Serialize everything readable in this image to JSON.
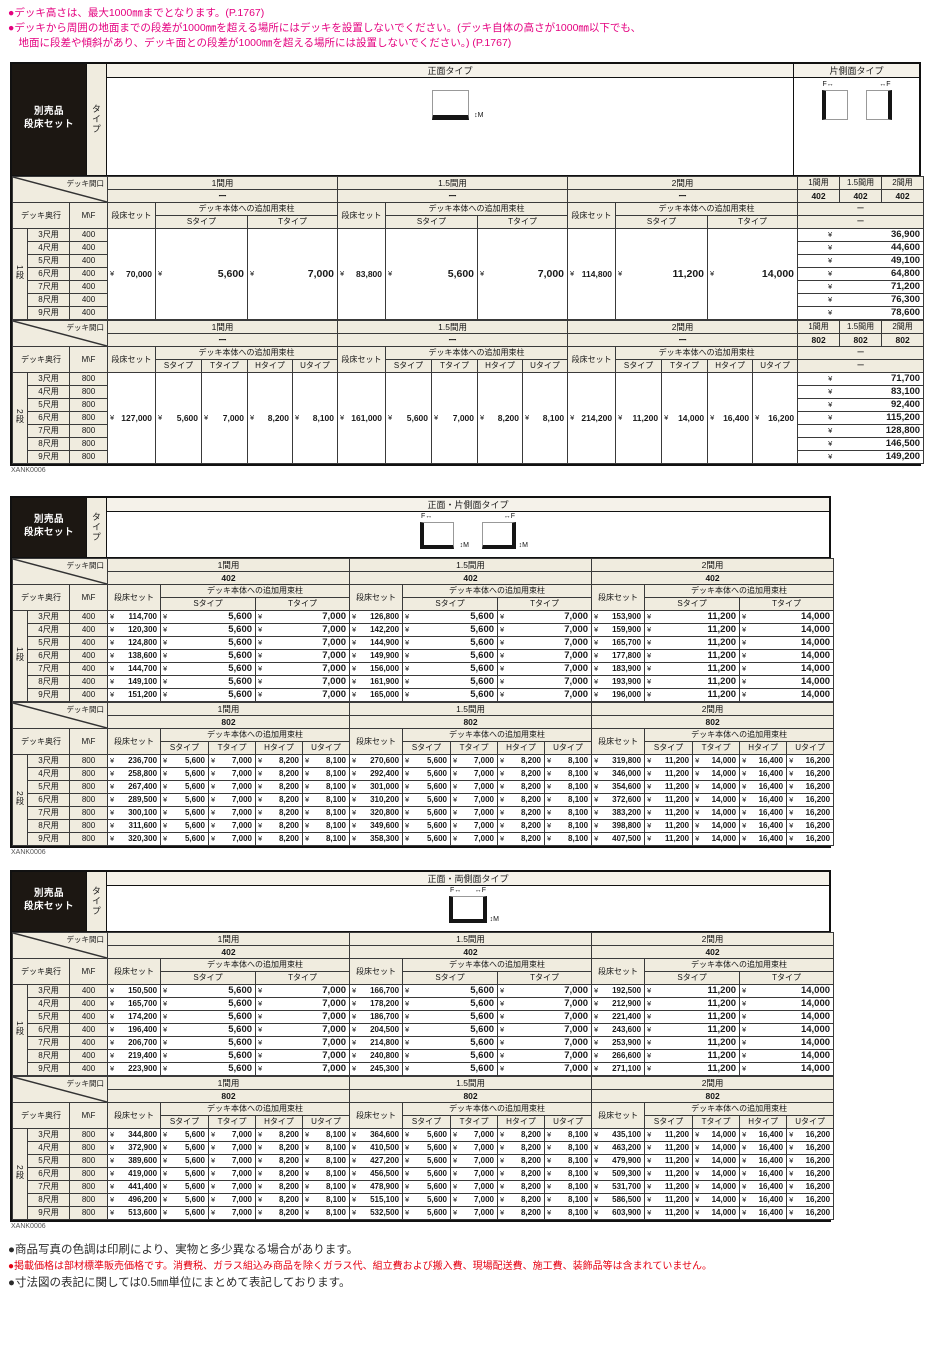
{
  "currency": "¥",
  "top_notes": [
    "●デッキ高さは、最大1000㎜までとなります。(P.1767)",
    "●デッキから周囲の地面までの段差が1000㎜を超える場所にはデッキを設置しないでください。(デッキ自体の高さが1000㎜以下でも、\n　地面に段差や傾斜があり、デッキ面との段差が1000㎜を超える場所には設置しないでください。) (P.1767)"
  ],
  "footer_notes": [
    {
      "text": "●商品写真の色調は印刷により、実物と多少異なる場合があります。",
      "color": "#2b2b2b"
    },
    {
      "text": "●掲載価格は部材標準販売価格です。消費税、ガラス組込み商品を除くガラス代、組立費および搬入費、現場配送費、施工費、装飾品等は含まれていません。",
      "color": "#e60012"
    },
    {
      "text": "●寸法図の表記に関しては0.5㎜単位にまとめて表記しております。",
      "color": "#2b2b2b"
    }
  ],
  "colors": {
    "accent_pink": "#e4007f",
    "note_red": "#e60012",
    "header_beige": "#f0ecdf",
    "badge_black": "#1c1712",
    "border_dark": "#111111"
  },
  "labels": {
    "badge": [
      "別売品",
      "段床セット"
    ],
    "type_vertical": "タイプ",
    "span_label": "デッキ間口",
    "depth_label": "デッキ奥行",
    "mf_label": "M\\F",
    "set_label": "段床セット",
    "add_label": "デッキ本体への追加用束柱",
    "dash": "ー",
    "marks": {
      "f": "F",
      "m": "M",
      "arrow_h": "↔",
      "arrow_v": "↕"
    }
  },
  "tables": [
    {
      "code": "XANK0006",
      "main_title": "正面タイプ",
      "side_title": "片側面タイプ",
      "diagram": "front",
      "has_side_block": true,
      "sections": [
        {
          "stage": "1段",
          "mf_value": "400",
          "groups": [
            "1間用",
            "1.5間用",
            "2間用"
          ],
          "group_sizes": [
            "ー",
            "ー",
            "ー"
          ],
          "side_groups": [
            "1間用",
            "1.5間用",
            "2間用"
          ],
          "side_sizes": [
            "402",
            "402",
            "402"
          ],
          "type_cols": [
            "Sタイプ",
            "Tタイプ"
          ],
          "merged_prices": [
            {
              "set": "70,000",
              "types": [
                "5,600",
                "7,000"
              ]
            },
            {
              "set": "83,800",
              "types": [
                "5,600",
                "7,000"
              ]
            },
            {
              "set": "114,800",
              "types": [
                "11,200",
                "14,000"
              ]
            }
          ],
          "rows": [
            {
              "depth": "3尺用",
              "side_price": "36,900"
            },
            {
              "depth": "4尺用",
              "side_price": "44,600"
            },
            {
              "depth": "5尺用",
              "side_price": "49,100"
            },
            {
              "depth": "6尺用",
              "side_price": "64,800"
            },
            {
              "depth": "7尺用",
              "side_price": "71,200"
            },
            {
              "depth": "8尺用",
              "side_price": "76,300"
            },
            {
              "depth": "9尺用",
              "side_price": "78,600"
            }
          ]
        },
        {
          "stage": "2段",
          "mf_value": "800",
          "groups": [
            "1間用",
            "1.5間用",
            "2間用"
          ],
          "group_sizes": [
            "ー",
            "ー",
            "ー"
          ],
          "side_groups": [
            "1間用",
            "1.5間用",
            "2間用"
          ],
          "side_sizes": [
            "802",
            "802",
            "802"
          ],
          "type_cols": [
            "Sタイプ",
            "Tタイプ",
            "Hタイプ",
            "Uタイプ"
          ],
          "merged_prices": [
            {
              "set": "127,000",
              "types": [
                "5,600",
                "7,000",
                "8,200",
                "8,100"
              ]
            },
            {
              "set": "161,000",
              "types": [
                "5,600",
                "7,000",
                "8,200",
                "8,100"
              ]
            },
            {
              "set": "214,200",
              "types": [
                "11,200",
                "14,000",
                "16,400",
                "16,200"
              ]
            }
          ],
          "rows": [
            {
              "depth": "3尺用",
              "side_price": "71,700"
            },
            {
              "depth": "4尺用",
              "side_price": "83,100"
            },
            {
              "depth": "5尺用",
              "side_price": "92,400"
            },
            {
              "depth": "6尺用",
              "side_price": "115,200"
            },
            {
              "depth": "7尺用",
              "side_price": "128,800"
            },
            {
              "depth": "8尺用",
              "side_price": "146,500"
            },
            {
              "depth": "9尺用",
              "side_price": "149,200"
            }
          ]
        }
      ]
    },
    {
      "code": "XANK0006",
      "main_title": "正面・片側面タイプ",
      "diagram": "front-side",
      "has_side_block": false,
      "sections": [
        {
          "stage": "1段",
          "mf_value": "400",
          "groups": [
            "1間用",
            "1.5間用",
            "2間用"
          ],
          "group_sizes": [
            "402",
            "402",
            "402"
          ],
          "type_cols": [
            "Sタイプ",
            "Tタイプ"
          ],
          "group_type_prices": [
            [
              "5,600",
              "7,000"
            ],
            [
              "5,600",
              "7,000"
            ],
            [
              "11,200",
              "14,000"
            ]
          ],
          "rows": [
            {
              "depth": "3尺用",
              "sets": [
                "114,700",
                "126,800",
                "153,900"
              ]
            },
            {
              "depth": "4尺用",
              "sets": [
                "120,300",
                "142,200",
                "159,900"
              ]
            },
            {
              "depth": "5尺用",
              "sets": [
                "124,800",
                "144,900",
                "165,700"
              ]
            },
            {
              "depth": "6尺用",
              "sets": [
                "138,600",
                "149,900",
                "177,800"
              ]
            },
            {
              "depth": "7尺用",
              "sets": [
                "144,700",
                "156,000",
                "183,900"
              ]
            },
            {
              "depth": "8尺用",
              "sets": [
                "149,100",
                "161,900",
                "193,900"
              ]
            },
            {
              "depth": "9尺用",
              "sets": [
                "151,200",
                "165,000",
                "196,000"
              ]
            }
          ]
        },
        {
          "stage": "2段",
          "mf_value": "800",
          "groups": [
            "1間用",
            "1.5間用",
            "2間用"
          ],
          "group_sizes": [
            "802",
            "802",
            "802"
          ],
          "type_cols": [
            "Sタイプ",
            "Tタイプ",
            "Hタイプ",
            "Uタイプ"
          ],
          "group_type_prices": [
            [
              "5,600",
              "7,000",
              "8,200",
              "8,100"
            ],
            [
              "5,600",
              "7,000",
              "8,200",
              "8,100"
            ],
            [
              "11,200",
              "14,000",
              "16,400",
              "16,200"
            ]
          ],
          "rows": [
            {
              "depth": "3尺用",
              "sets": [
                "236,700",
                "270,600",
                "319,800"
              ]
            },
            {
              "depth": "4尺用",
              "sets": [
                "258,800",
                "292,400",
                "346,000"
              ]
            },
            {
              "depth": "5尺用",
              "sets": [
                "267,400",
                "301,000",
                "354,600"
              ]
            },
            {
              "depth": "6尺用",
              "sets": [
                "289,500",
                "310,200",
                "372,600"
              ]
            },
            {
              "depth": "7尺用",
              "sets": [
                "300,100",
                "320,800",
                "383,200"
              ]
            },
            {
              "depth": "8尺用",
              "sets": [
                "311,600",
                "349,600",
                "398,800"
              ]
            },
            {
              "depth": "9尺用",
              "sets": [
                "320,300",
                "358,300",
                "407,500"
              ]
            }
          ]
        }
      ]
    },
    {
      "code": "XANK0006",
      "main_title": "正面・両側面タイプ",
      "diagram": "front-both",
      "has_side_block": false,
      "sections": [
        {
          "stage": "1段",
          "mf_value": "400",
          "groups": [
            "1間用",
            "1.5間用",
            "2間用"
          ],
          "group_sizes": [
            "402",
            "402",
            "402"
          ],
          "type_cols": [
            "Sタイプ",
            "Tタイプ"
          ],
          "group_type_prices": [
            [
              "5,600",
              "7,000"
            ],
            [
              "5,600",
              "7,000"
            ],
            [
              "11,200",
              "14,000"
            ]
          ],
          "rows": [
            {
              "depth": "3尺用",
              "sets": [
                "150,500",
                "166,700",
                "192,500"
              ]
            },
            {
              "depth": "4尺用",
              "sets": [
                "165,700",
                "178,200",
                "212,900"
              ]
            },
            {
              "depth": "5尺用",
              "sets": [
                "174,200",
                "186,700",
                "221,400"
              ]
            },
            {
              "depth": "6尺用",
              "sets": [
                "196,400",
                "204,500",
                "243,600"
              ]
            },
            {
              "depth": "7尺用",
              "sets": [
                "206,700",
                "214,800",
                "253,900"
              ]
            },
            {
              "depth": "8尺用",
              "sets": [
                "219,400",
                "240,800",
                "266,600"
              ]
            },
            {
              "depth": "9尺用",
              "sets": [
                "223,900",
                "245,300",
                "271,100"
              ]
            }
          ]
        },
        {
          "stage": "2段",
          "mf_value": "800",
          "groups": [
            "1間用",
            "1.5間用",
            "2間用"
          ],
          "group_sizes": [
            "802",
            "802",
            "802"
          ],
          "type_cols": [
            "Sタイプ",
            "Tタイプ",
            "Hタイプ",
            "Uタイプ"
          ],
          "group_type_prices": [
            [
              "5,600",
              "7,000",
              "8,200",
              "8,100"
            ],
            [
              "5,600",
              "7,000",
              "8,200",
              "8,100"
            ],
            [
              "11,200",
              "14,000",
              "16,400",
              "16,200"
            ]
          ],
          "rows": [
            {
              "depth": "3尺用",
              "sets": [
                "344,800",
                "364,600",
                "435,100"
              ]
            },
            {
              "depth": "4尺用",
              "sets": [
                "372,900",
                "410,500",
                "463,200"
              ]
            },
            {
              "depth": "5尺用",
              "sets": [
                "389,600",
                "427,200",
                "479,900"
              ]
            },
            {
              "depth": "6尺用",
              "sets": [
                "419,000",
                "456,500",
                "509,300"
              ]
            },
            {
              "depth": "7尺用",
              "sets": [
                "441,400",
                "478,900",
                "531,700"
              ]
            },
            {
              "depth": "8尺用",
              "sets": [
                "496,200",
                "515,100",
                "586,500"
              ]
            },
            {
              "depth": "9尺用",
              "sets": [
                "513,600",
                "532,500",
                "603,900"
              ]
            }
          ]
        }
      ]
    }
  ]
}
